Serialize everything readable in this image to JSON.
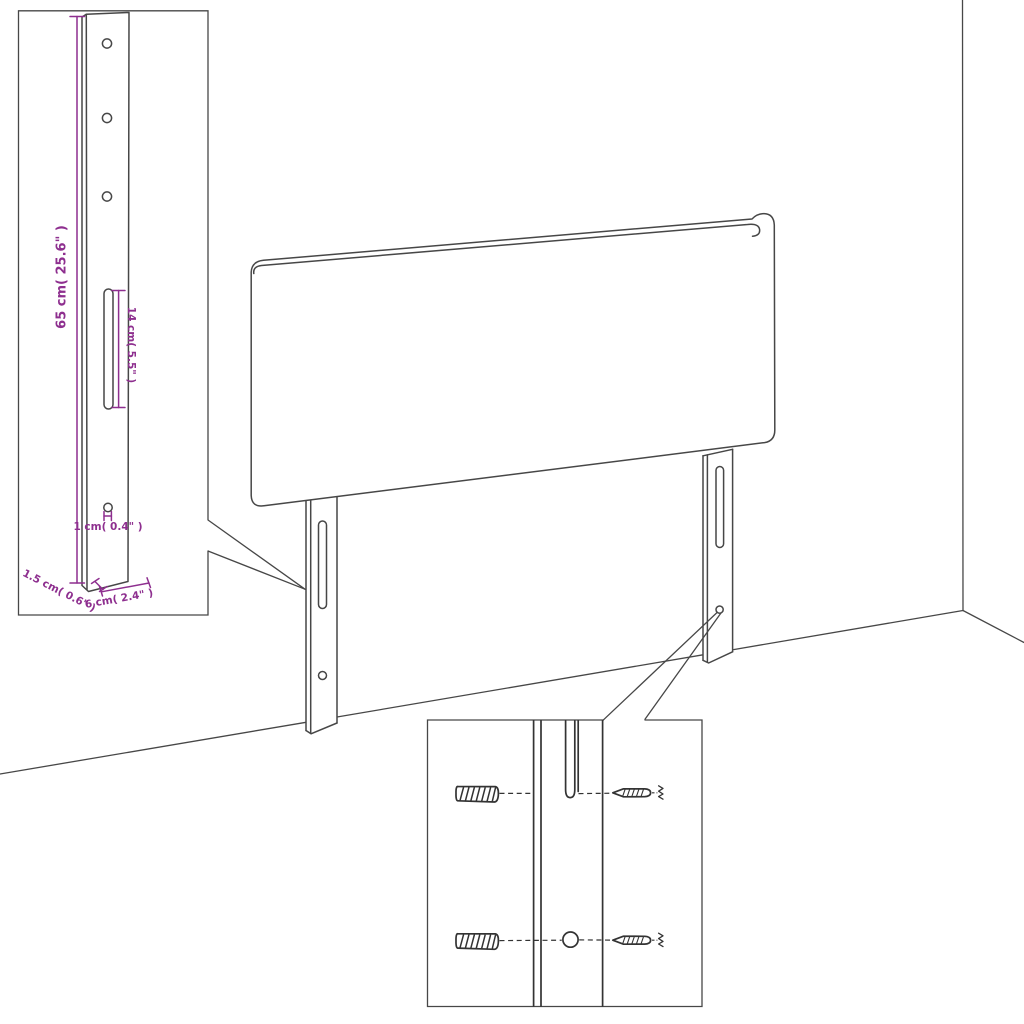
{
  "diagram": {
    "type": "product-dimension-diagram",
    "subject": "headboard with two mounting legs shown in a room corner",
    "detail_inset_top_left": {
      "labels": {
        "leg_height": "65 cm( 25.6\" )",
        "slot_length": "14 cm( 5.5\" )",
        "hole_diameter": "1 cm( 0.4\" )",
        "leg_depth": "1.5 cm( 0.6\" )",
        "leg_width": "6 cm( 2.4\" )"
      }
    },
    "detail_inset_bottom": {
      "shows": "wall plugs and screws aligned with leg slot and hole"
    },
    "colors": {
      "dimension_accent": "#8e2f8f",
      "line_color": "#474747",
      "detail_dark": "#333333",
      "background": "#ffffff"
    }
  }
}
